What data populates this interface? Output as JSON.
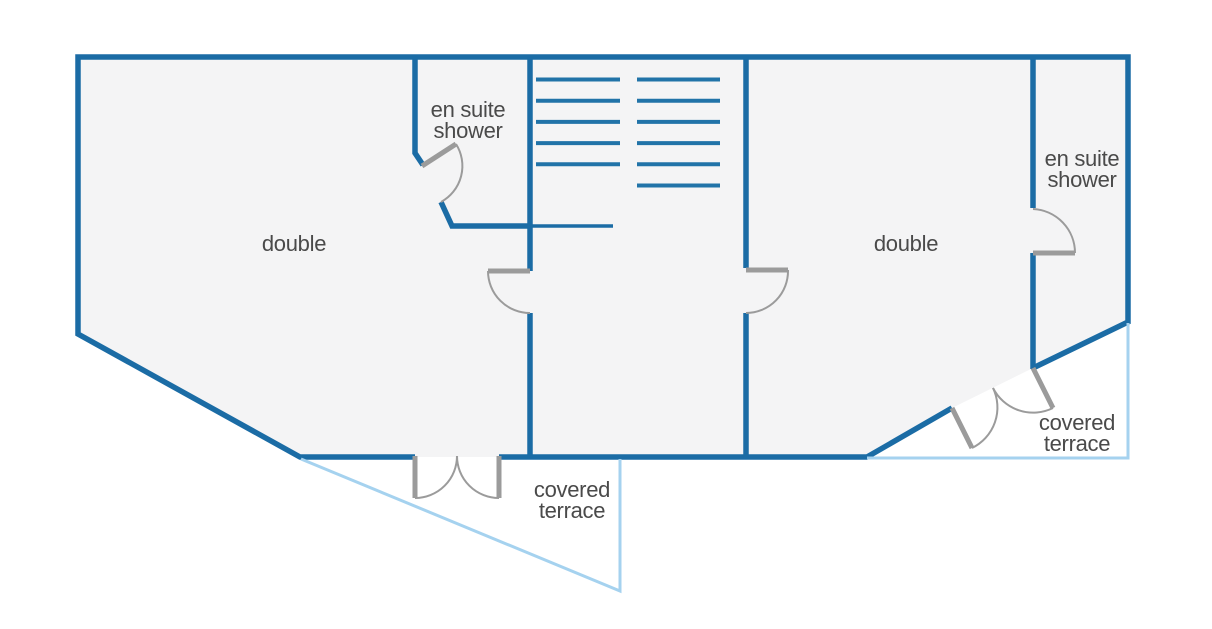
{
  "floor_plan": {
    "rooms": {
      "double_left": {
        "label": "double"
      },
      "double_right": {
        "label": "double"
      },
      "ensuite_left": {
        "line1": "en suite",
        "line2": "shower"
      },
      "ensuite_right": {
        "line1": "en suite",
        "line2": "shower"
      },
      "terrace_left": {
        "line1": "covered",
        "line2": "terrace"
      },
      "terrace_right": {
        "line1": "covered",
        "line2": "terrace"
      }
    },
    "stairs": {
      "left_tread_count": 5,
      "right_tread_count": 6
    },
    "colors": {
      "wall": "#1b6ca5",
      "stair": "#2173a8",
      "terrace_outline": "#a5d2ef",
      "door": "#9b9b9b",
      "floor_fill": "#f4f4f5",
      "label_text": "#4a4a4a",
      "background": "#ffffff"
    }
  }
}
